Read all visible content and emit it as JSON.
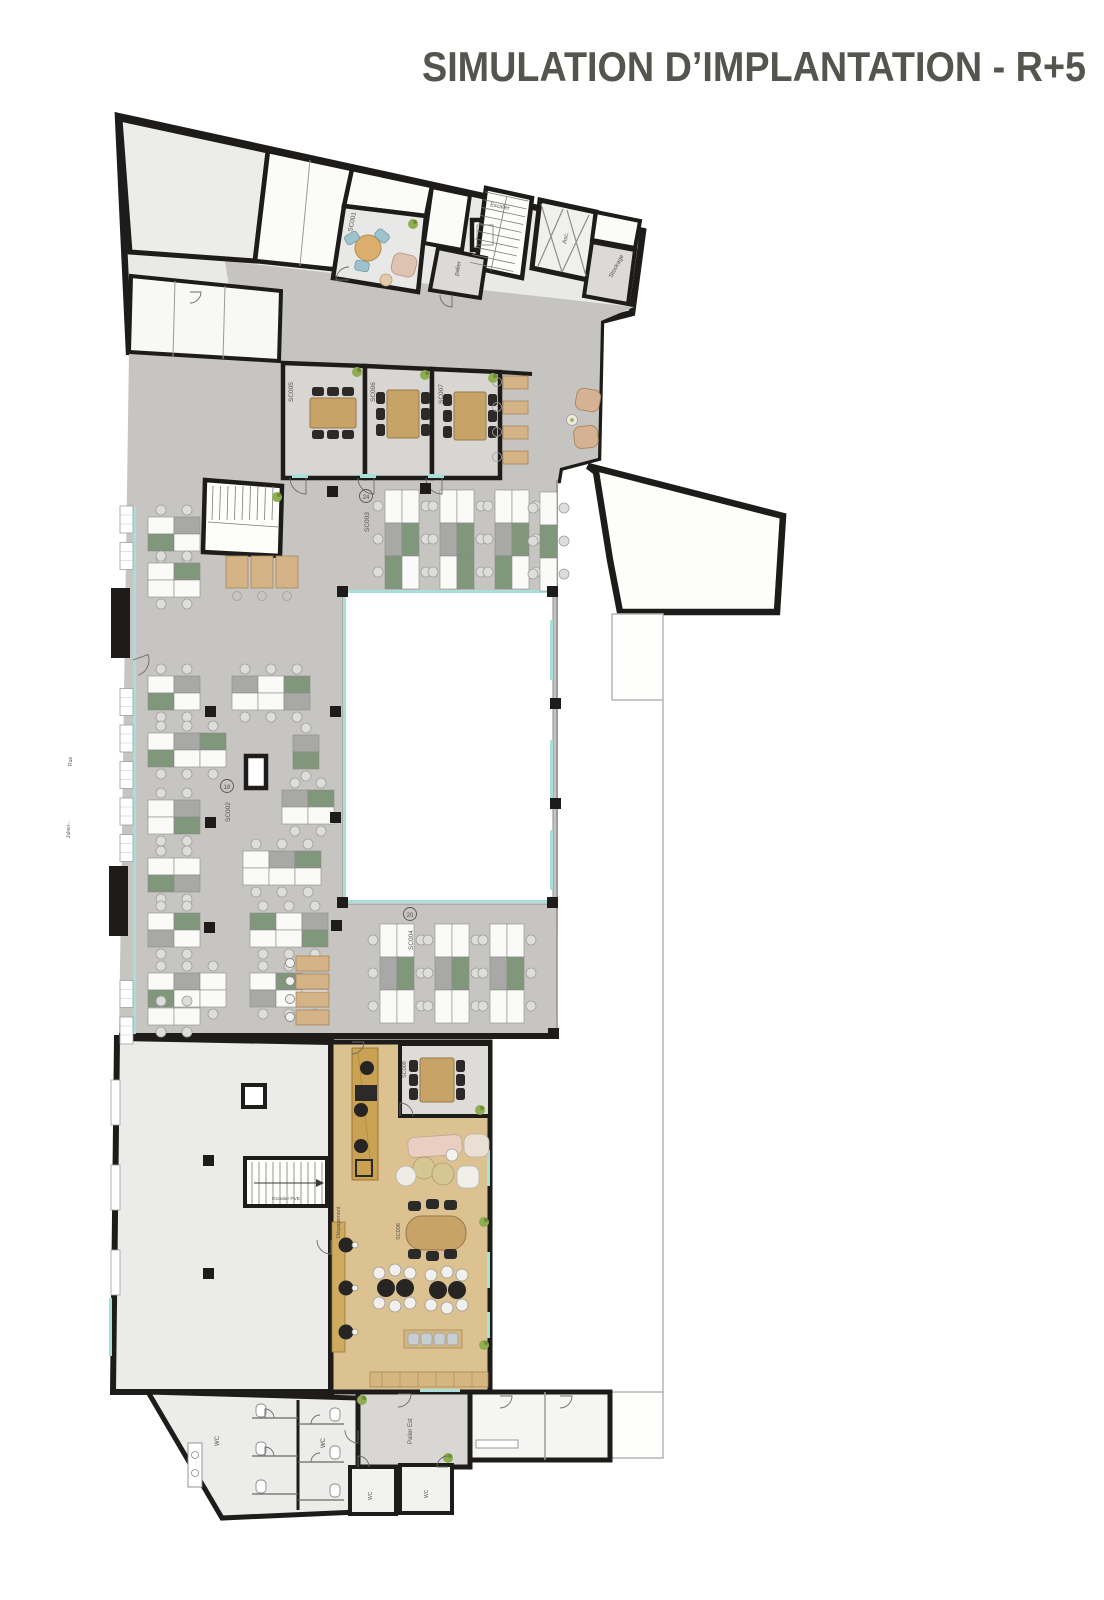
{
  "title": {
    "text": "SIMULATION D’IMPLANTATION - R+5"
  },
  "colors": {
    "title_brown": "#a98366",
    "wall_black": "#1e1c1a",
    "carpet_gray": "#c7c5c1",
    "room_light": "#e9e9e8",
    "floor_tan": "#dcc291",
    "wood": "#c7a368",
    "desk_green": "#81977c",
    "desk_gray": "#a8a8a6",
    "glazing_cyan": "#a9dedb",
    "plant_green": "#8fae52"
  },
  "plan": {
    "rooms": {
      "lounge_code": "SC001",
      "palier": "palier",
      "escalier_top": "Escalier",
      "ascenseur": "Asc.",
      "stockage": "Stockage",
      "meeting1": "SC005",
      "meeting2": "SC006",
      "meeting3": "SC007",
      "open_top": {
        "code": "SC003",
        "seats": "24"
      },
      "open_mid": {
        "code": "SC002",
        "seats": "18"
      },
      "open_bottom": {
        "code": "SC004",
        "seats": "20"
      },
      "cafeteria_meeting": "SC009",
      "cafeteria_dining": "SC008",
      "degagement": "Dégagement",
      "escalier_bottom": "Escalier PVE",
      "palier_est": "Palier Est",
      "wc_left": "WC",
      "wc_center": "WC",
      "wc_small_left": "WC",
      "wc_small_right": "WC",
      "street_1": "Rue",
      "street_2": "Julien-..."
    }
  }
}
